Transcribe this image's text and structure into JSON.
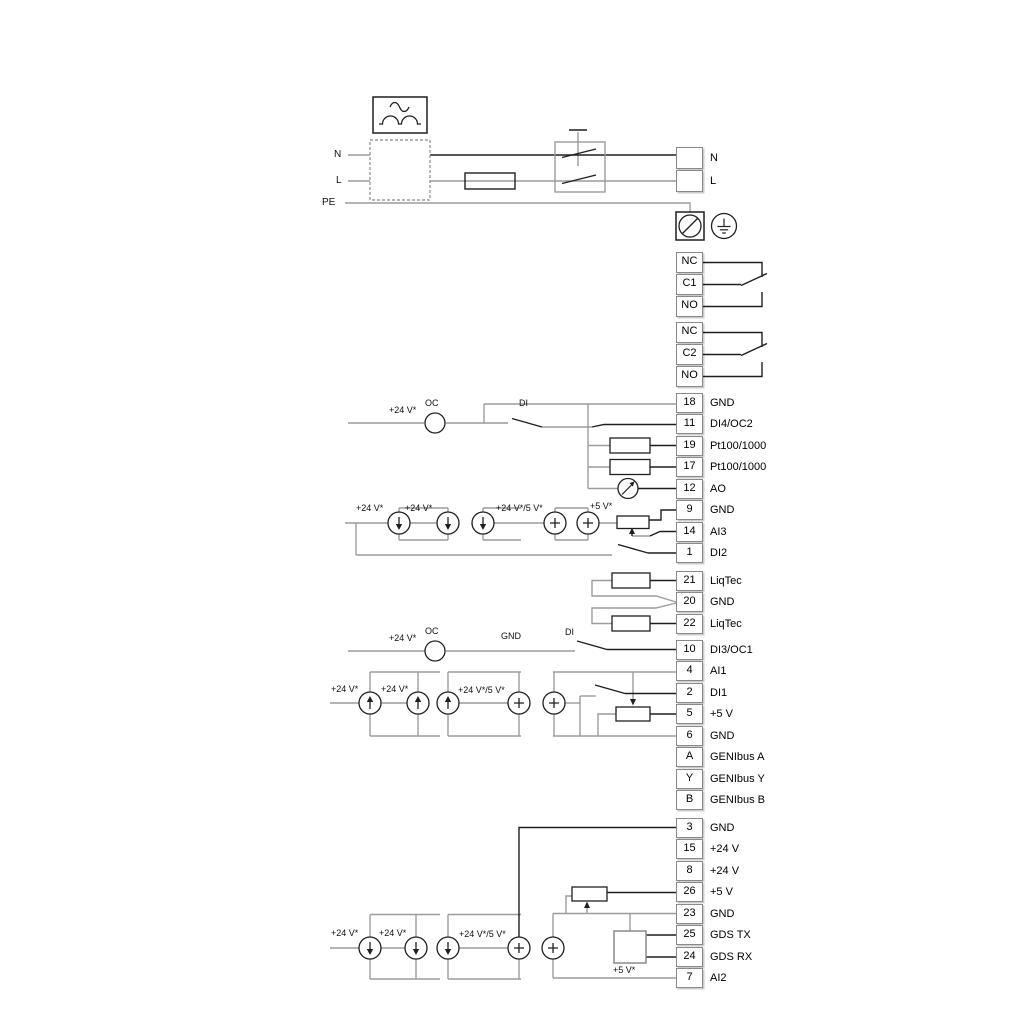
{
  "labels": {
    "n_left": "N",
    "l_left": "L",
    "pe_left": "PE",
    "oc": "OC",
    "di": "DI",
    "gnd": "GND",
    "plus24": "+24 V*",
    "plus24_5": "+24 V*/5 V*",
    "plus5": "+5 V*"
  },
  "terminal_groups": [
    {
      "id": "mains",
      "rows": [
        {
          "num": "",
          "label": "N"
        },
        {
          "num": "",
          "label": "L"
        }
      ]
    },
    {
      "id": "relay1",
      "rows": [
        {
          "num": "NC",
          "label": ""
        },
        {
          "num": "C1",
          "label": ""
        },
        {
          "num": "NO",
          "label": ""
        }
      ]
    },
    {
      "id": "relay2",
      "rows": [
        {
          "num": "NC",
          "label": ""
        },
        {
          "num": "C2",
          "label": ""
        },
        {
          "num": "NO",
          "label": ""
        }
      ]
    },
    {
      "id": "io1",
      "rows": [
        {
          "num": "18",
          "label": "GND"
        },
        {
          "num": "11",
          "label": "DI4/OC2"
        },
        {
          "num": "19",
          "label": "Pt100/1000"
        },
        {
          "num": "17",
          "label": "Pt100/1000"
        },
        {
          "num": "12",
          "label": "AO"
        },
        {
          "num": "9",
          "label": "GND"
        },
        {
          "num": "14",
          "label": "AI3"
        },
        {
          "num": "1",
          "label": "DI2"
        }
      ]
    },
    {
      "id": "liqtec",
      "rows": [
        {
          "num": "21",
          "label": "LiqTec"
        },
        {
          "num": "20",
          "label": "GND"
        },
        {
          "num": "22",
          "label": "LiqTec"
        }
      ]
    },
    {
      "id": "io2",
      "rows": [
        {
          "num": "10",
          "label": "DI3/OC1"
        },
        {
          "num": "4",
          "label": "AI1"
        },
        {
          "num": "2",
          "label": "DI1"
        },
        {
          "num": "5",
          "label": "+5 V"
        },
        {
          "num": "6",
          "label": "GND"
        },
        {
          "num": "A",
          "label": "GENIbus A"
        },
        {
          "num": "Y",
          "label": "GENIbus Y"
        },
        {
          "num": "B",
          "label": "GENIbus B"
        }
      ]
    },
    {
      "id": "io3",
      "rows": [
        {
          "num": "3",
          "label": "GND"
        },
        {
          "num": "15",
          "label": "+24 V"
        },
        {
          "num": "8",
          "label": "+24 V"
        },
        {
          "num": "26",
          "label": "+5 V"
        },
        {
          "num": "23",
          "label": "GND"
        },
        {
          "num": "25",
          "label": "GDS TX"
        },
        {
          "num": "24",
          "label": "GDS RX"
        },
        {
          "num": "7",
          "label": "AI2"
        }
      ]
    }
  ],
  "colors": {
    "wire_gray": "#9c9c9c",
    "wire_dark": "#1f1f1f",
    "cell_border": "#8a8a8a",
    "text": "#000000"
  }
}
